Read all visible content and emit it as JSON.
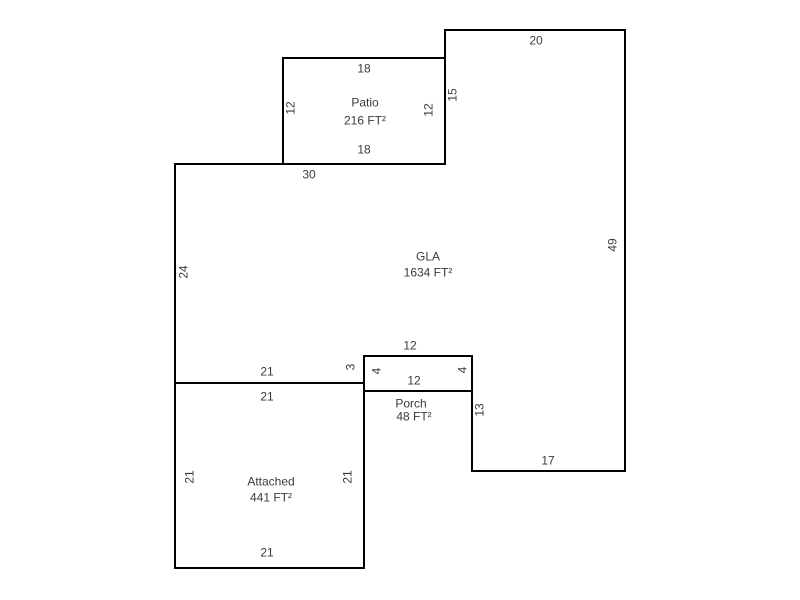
{
  "sketch": {
    "regions": {
      "patio": {
        "label": "Patio",
        "area": "216 FT²"
      },
      "gla": {
        "label": "GLA",
        "area": "1634 FT²"
      },
      "porch": {
        "label": "Porch",
        "area": "48 FT²"
      },
      "attached": {
        "label": "Attached",
        "area": "441 FT²"
      }
    },
    "dims": {
      "top_20": "20",
      "seg_15": "15",
      "patio_top_18": "18",
      "patio_left_12": "12",
      "patio_right_12": "12",
      "patio_bottom_18": "18",
      "gla_top_30": "30",
      "gla_left_24": "24",
      "right_49": "49",
      "porch_top_12": "12",
      "porch_left_4": "4",
      "porch_inner_12": "12",
      "porch_right_4": "4",
      "seg_3": "3",
      "gla_bottom_21": "21",
      "attached_top_21": "21",
      "seg_13": "13",
      "bottom_17": "17",
      "attached_left_21": "21",
      "attached_right_21": "21",
      "attached_bottom_21": "21"
    }
  }
}
